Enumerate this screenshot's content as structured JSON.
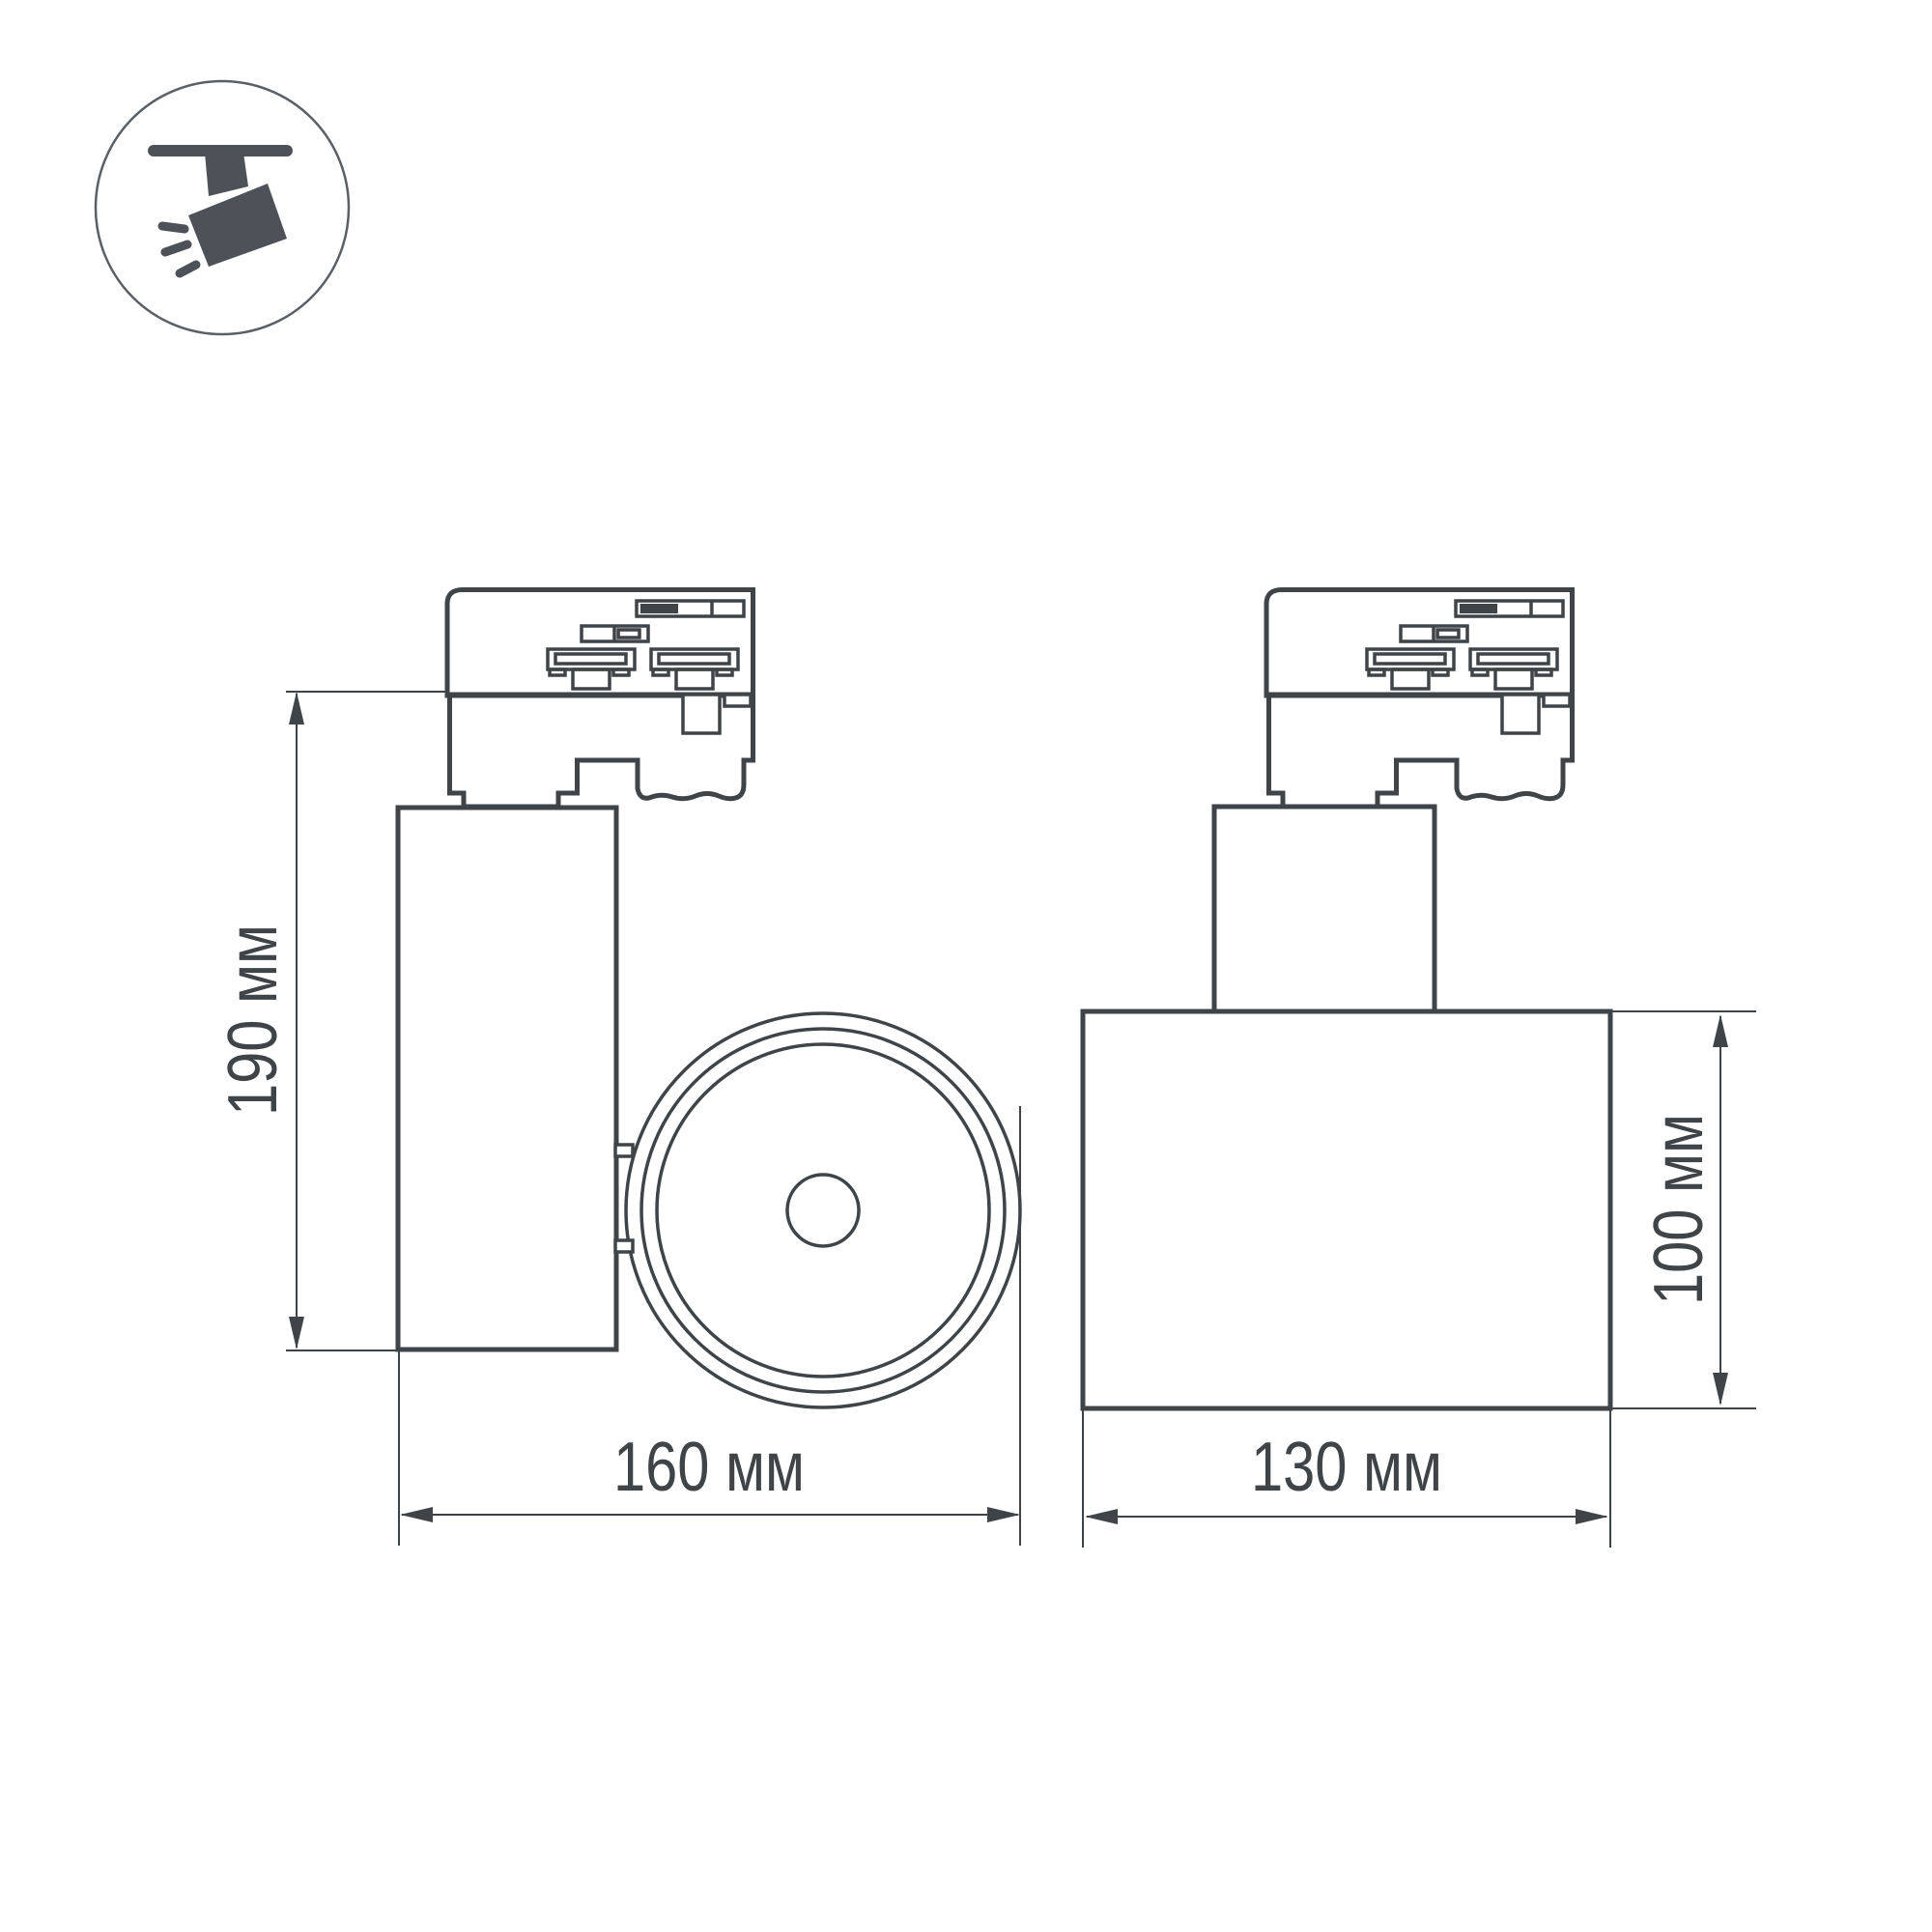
{
  "icon": {
    "name": "ceiling-track-spotlight"
  },
  "dimensions": {
    "side_height": "190 мм",
    "side_width": "160 мм",
    "front_width": "130 мм",
    "front_height": "100 мм"
  },
  "colors": {
    "line": "#3f4449",
    "icon_fill": "#4c5258",
    "icon_ring": "#5a6066",
    "background": "#ffffff"
  }
}
